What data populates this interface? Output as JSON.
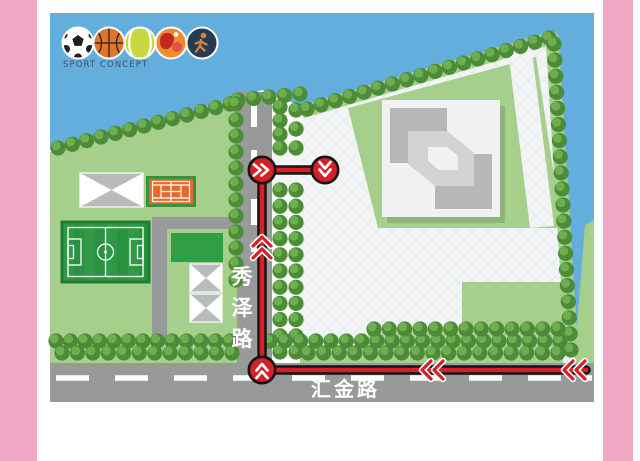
{
  "frame": {
    "background": "#ffffff",
    "pink": "#f1a6c4"
  },
  "palette": {
    "water": "#64aedd",
    "lawn": "#a7cf8c",
    "tree_dark": "#4c8b38",
    "tree_light": "#6fae4f",
    "road": "#97999b",
    "dash": "#ffffff",
    "site": "#f3f4f5",
    "grid_line": "#e2e5e7",
    "pitch_green": "#2f9e47",
    "court_orange": "#e4692b",
    "court_frame": "#39913f",
    "field_green_a": "#2f9948",
    "field_green_b": "#29913f",
    "field_border": "#1d7c31",
    "pavilion_gray": "#b9babc",
    "building_base": "#f1f1f2",
    "building_dark": "#b6b7b9",
    "building_mid": "#d2d3d5"
  },
  "legend": {
    "caption": "SPORT CONCEPT",
    "icons": [
      {
        "name": "soccer-ball-icon"
      },
      {
        "name": "basketball-icon"
      },
      {
        "name": "tennis-ball-icon"
      },
      {
        "name": "table-tennis-icon"
      },
      {
        "name": "athlete-icon"
      }
    ]
  },
  "roads": {
    "vertical_road_name": "秀泽路",
    "horizontal_road_name": "汇金路"
  },
  "route": {
    "color": "#d62027",
    "outline": "#141414",
    "segments": [
      [
        262,
        170,
        325,
        170
      ],
      [
        262,
        170,
        262,
        370
      ],
      [
        262,
        370,
        586,
        370
      ]
    ],
    "nodes": [
      {
        "x": 262,
        "y": 170,
        "dir": "right"
      },
      {
        "x": 325,
        "y": 170,
        "dir": "down"
      },
      {
        "x": 262,
        "y": 370,
        "dir": "up"
      }
    ],
    "arrows": [
      {
        "x": 262,
        "y": 247,
        "dir": "up"
      },
      {
        "x": 432,
        "y": 370,
        "dir": "left"
      },
      {
        "x": 574,
        "y": 370,
        "dir": "left"
      }
    ]
  }
}
